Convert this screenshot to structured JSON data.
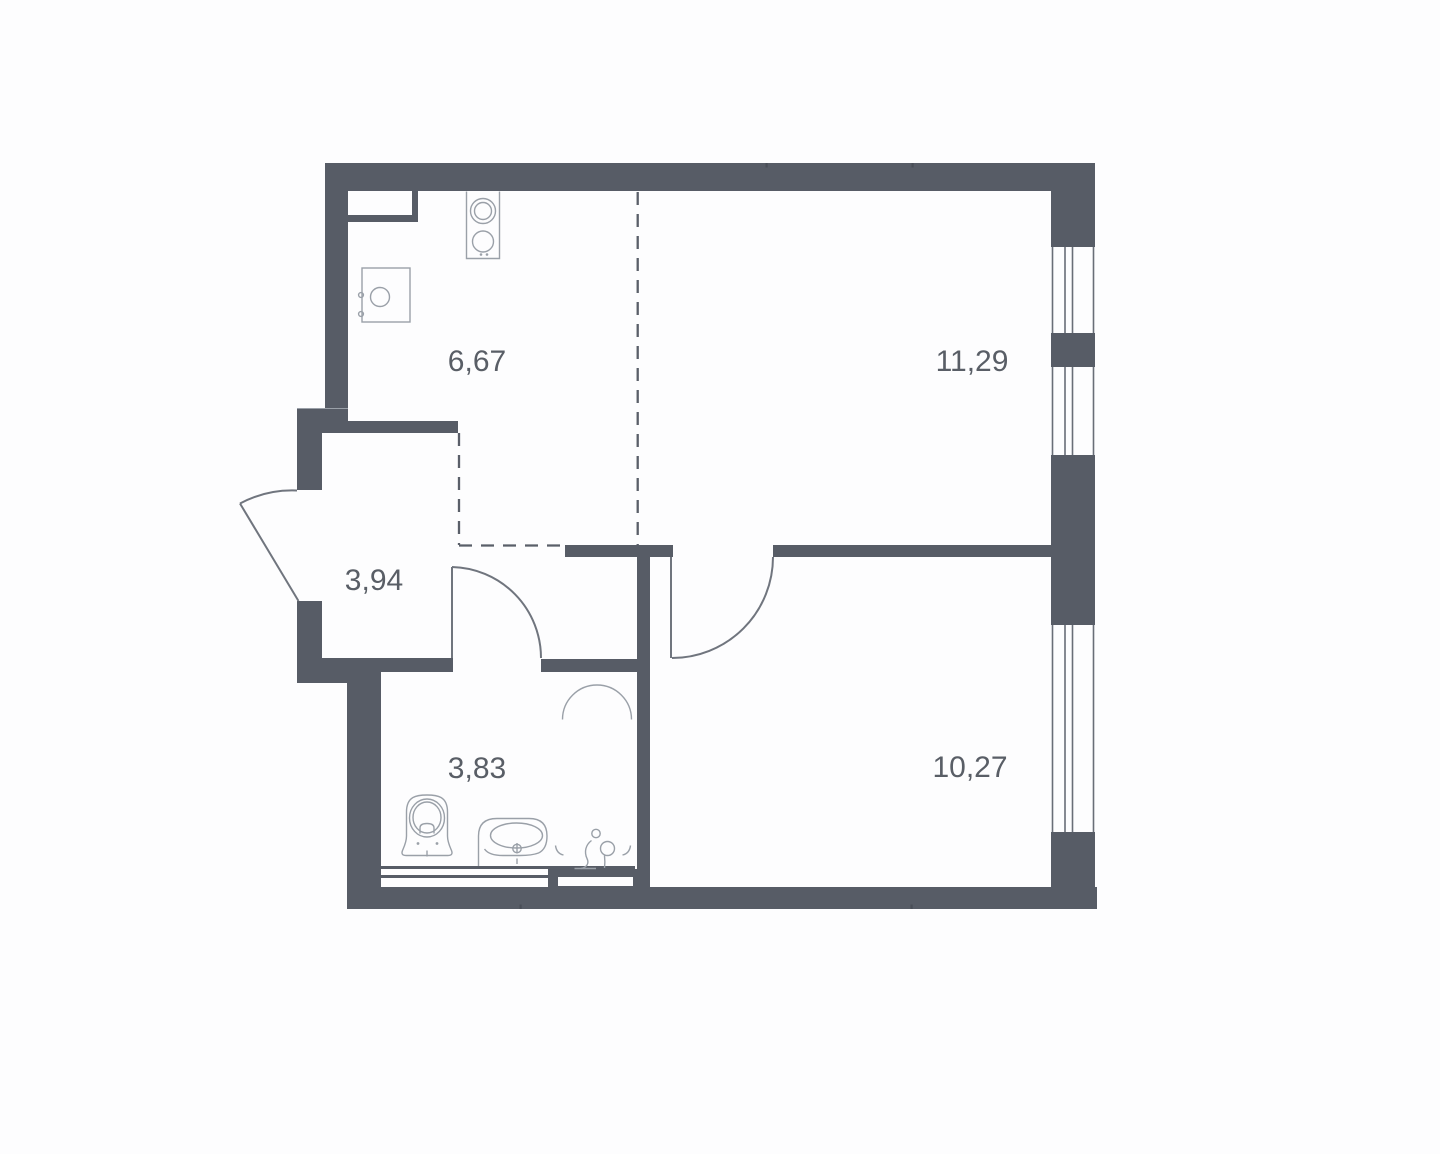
{
  "plan": {
    "title": "apartment-floor-plan",
    "rooms": [
      {
        "id": "kitchen",
        "area": "6,67"
      },
      {
        "id": "living-room",
        "area": "11,29"
      },
      {
        "id": "hallway",
        "area": "3,94"
      },
      {
        "id": "bathroom",
        "area": "3,83"
      },
      {
        "id": "bedroom",
        "area": "10,27"
      }
    ]
  },
  "colors": {
    "bg": "#fdfdfe",
    "wall": "#575c66",
    "door": "#70757e",
    "dash": "#5a5f69",
    "fixture": "#9aa0a8",
    "winline": "#696e77",
    "label": "#595e66",
    "tickmark": "#494e57"
  }
}
